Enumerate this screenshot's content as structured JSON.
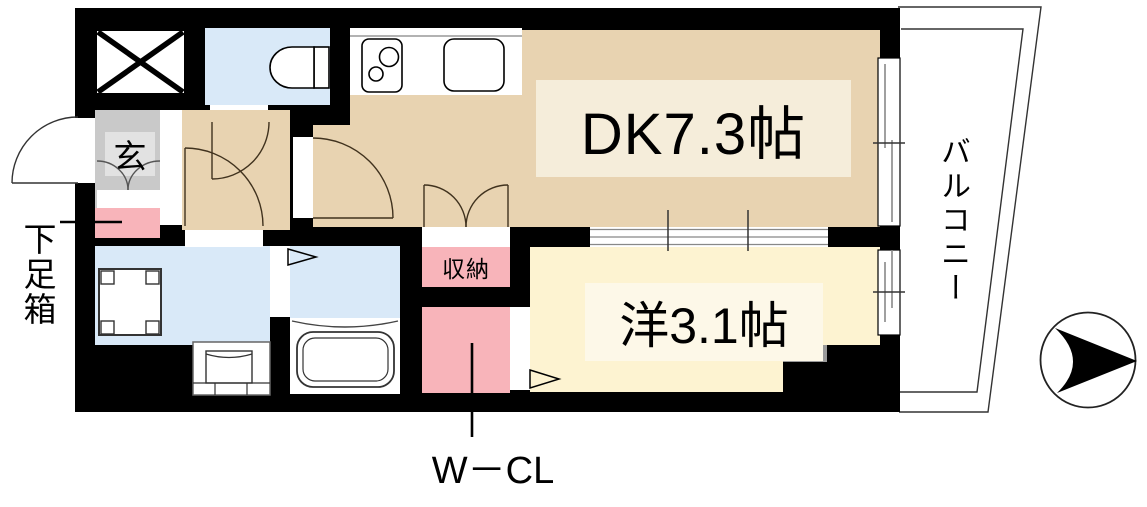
{
  "plan": {
    "type": "apartment-floor-plan",
    "rooms": {
      "dining_kitchen": {
        "label": "DK7.3帖",
        "size_jo": 7.3
      },
      "western_room": {
        "label": "洋3.1帖",
        "size_jo": 3.1
      },
      "entrance": {
        "label": "玄"
      },
      "storage": {
        "label": "収納"
      },
      "walk_in_closet": {
        "label": "W－CL"
      },
      "balcony": {
        "label": "バルコニー"
      },
      "shoe_box": {
        "label": "下足箱"
      }
    },
    "fixtures": [
      "elevator-shaft",
      "toilet",
      "kitchen-stove",
      "kitchen-sink",
      "washing-machine-space",
      "vanity-basin",
      "bathtub",
      "north-arrow"
    ],
    "colors": {
      "wall": "#000000",
      "dk_floor": "#e8d3b1",
      "dk_label_bg": "#f5edda",
      "western_floor": "#fdf3d1",
      "western_label_bg": "#fdf8e8",
      "water_area": "#d9e9f8",
      "closet_pink": "#f8b4ba",
      "entrance_gray": "#c9c9c9",
      "entrance_inner_gray": "#e2e2e2",
      "pillar_gray": "#9a9a9a",
      "fixture_white": "#ffffff"
    }
  }
}
